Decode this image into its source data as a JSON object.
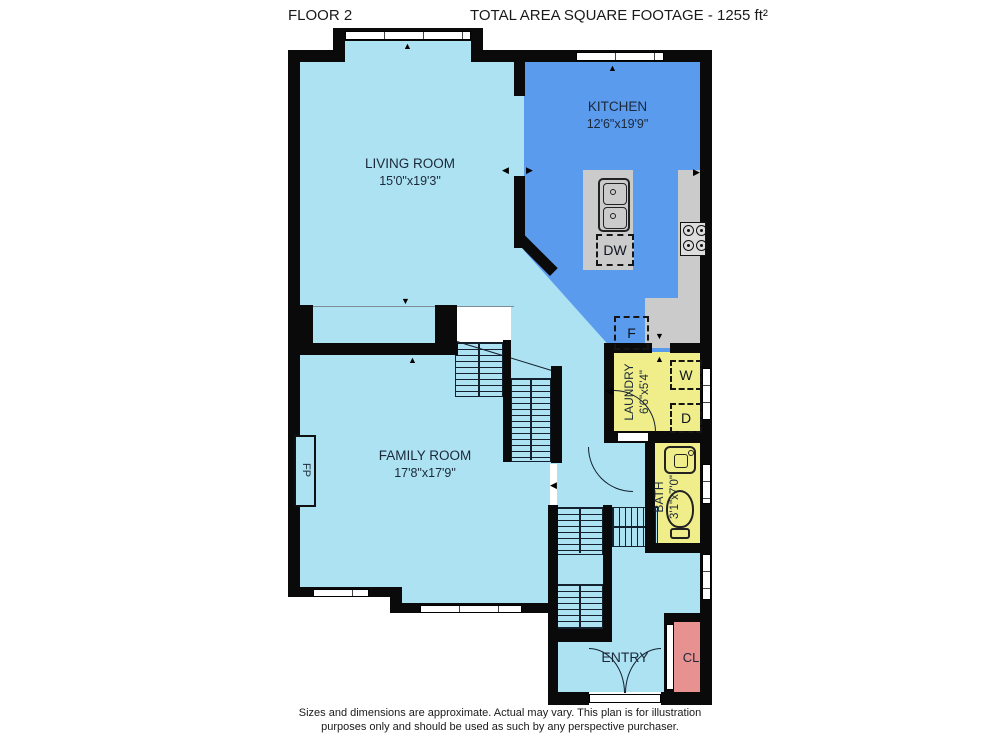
{
  "header": {
    "floor_label": "FLOOR 2",
    "area_label": "TOTAL AREA SQUARE FOOTAGE - 1255 ft²"
  },
  "rooms": {
    "living": {
      "name": "LIVING ROOM",
      "dims": "15'0\"x19'3\""
    },
    "kitchen": {
      "name": "KITCHEN",
      "dims": "12'6\"x19'9\""
    },
    "family": {
      "name": "FAMILY ROOM",
      "dims": "17'8\"x17'9\""
    },
    "laundry": {
      "name": "LAUNDRY",
      "dims": "6'6\"x5'4\""
    },
    "bath": {
      "name": "BATH",
      "dims": "3'1\"x7'0\""
    },
    "entry": {
      "name": "ENTRY"
    },
    "closet": {
      "name": "CL"
    }
  },
  "labels": {
    "washer": "W",
    "dryer": "D",
    "fridge": "F",
    "dishwasher": "DW",
    "fireplace": "FP"
  },
  "colors": {
    "room": "#ade2f2",
    "kitchen": "#5b9bee",
    "utility": "#f0ee8a",
    "closet": "#e89191",
    "counter": "#cbcbcb",
    "wall": "#0a0a0a"
  },
  "footer": {
    "line1": "Sizes and dimensions are approximate. Actual may vary. This plan is for illustration",
    "line2": "purposes only and should be used as such by any perspective purchaser."
  }
}
